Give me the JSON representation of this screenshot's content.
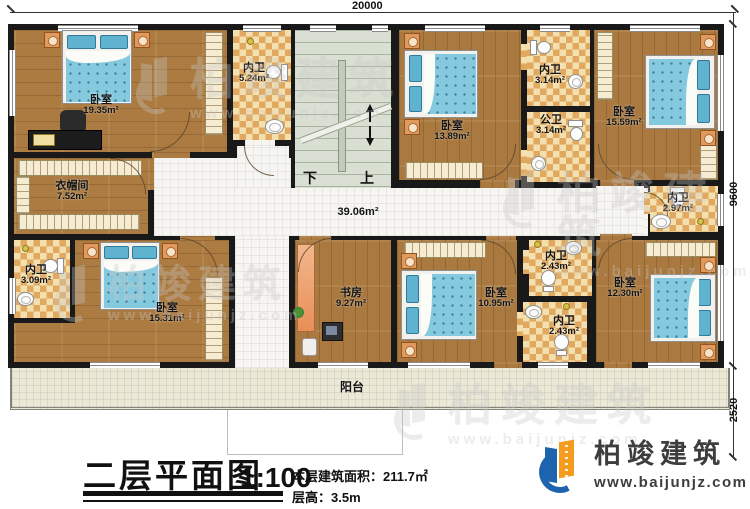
{
  "dims": {
    "top": "20000",
    "right_main": "9600",
    "right_balcony": "2520"
  },
  "stairs": {
    "down": "下",
    "up": "上"
  },
  "rooms": {
    "bedroom1": {
      "name": "卧室",
      "area": "19.35m²"
    },
    "bath_524": {
      "name": "内卫",
      "area": "5.24m²"
    },
    "bedroom2": {
      "name": "卧室",
      "area": "13.89m²"
    },
    "bath_314": {
      "name": "内卫",
      "area": "3.14m²"
    },
    "bath_public": {
      "name": "公卫",
      "area": "3.14m²"
    },
    "bedroom3": {
      "name": "卧室",
      "area": "15.59m²"
    },
    "bath_297": {
      "name": "内卫",
      "area": "2.97m²"
    },
    "cloakroom": {
      "name": "衣帽间",
      "area": "7.52m²"
    },
    "hall": {
      "area": "39.06m²"
    },
    "bath_309": {
      "name": "内卫",
      "area": "3.09m²"
    },
    "bedroom4": {
      "name": "卧室",
      "area": "15.31m²"
    },
    "study": {
      "name": "书房",
      "area": "9.27m²"
    },
    "bedroom5": {
      "name": "卧室",
      "area": "10.95m²"
    },
    "bath_243a": {
      "name": "内卫",
      "area": "2.43m²"
    },
    "bath_243b": {
      "name": "内卫",
      "area": "2.43m²"
    },
    "bedroom6": {
      "name": "卧室",
      "area": "12.30m²"
    },
    "balcony": {
      "name": "阳台"
    }
  },
  "title_block": {
    "title": "二层平面图",
    "scale": "1:100",
    "area_label": "本层建筑面积：",
    "area_value": "211.7㎡",
    "height_label": "层高：",
    "height_value": "3.5m"
  },
  "brand": {
    "name": "柏竣建筑",
    "url": "www.baijunjz.com"
  }
}
